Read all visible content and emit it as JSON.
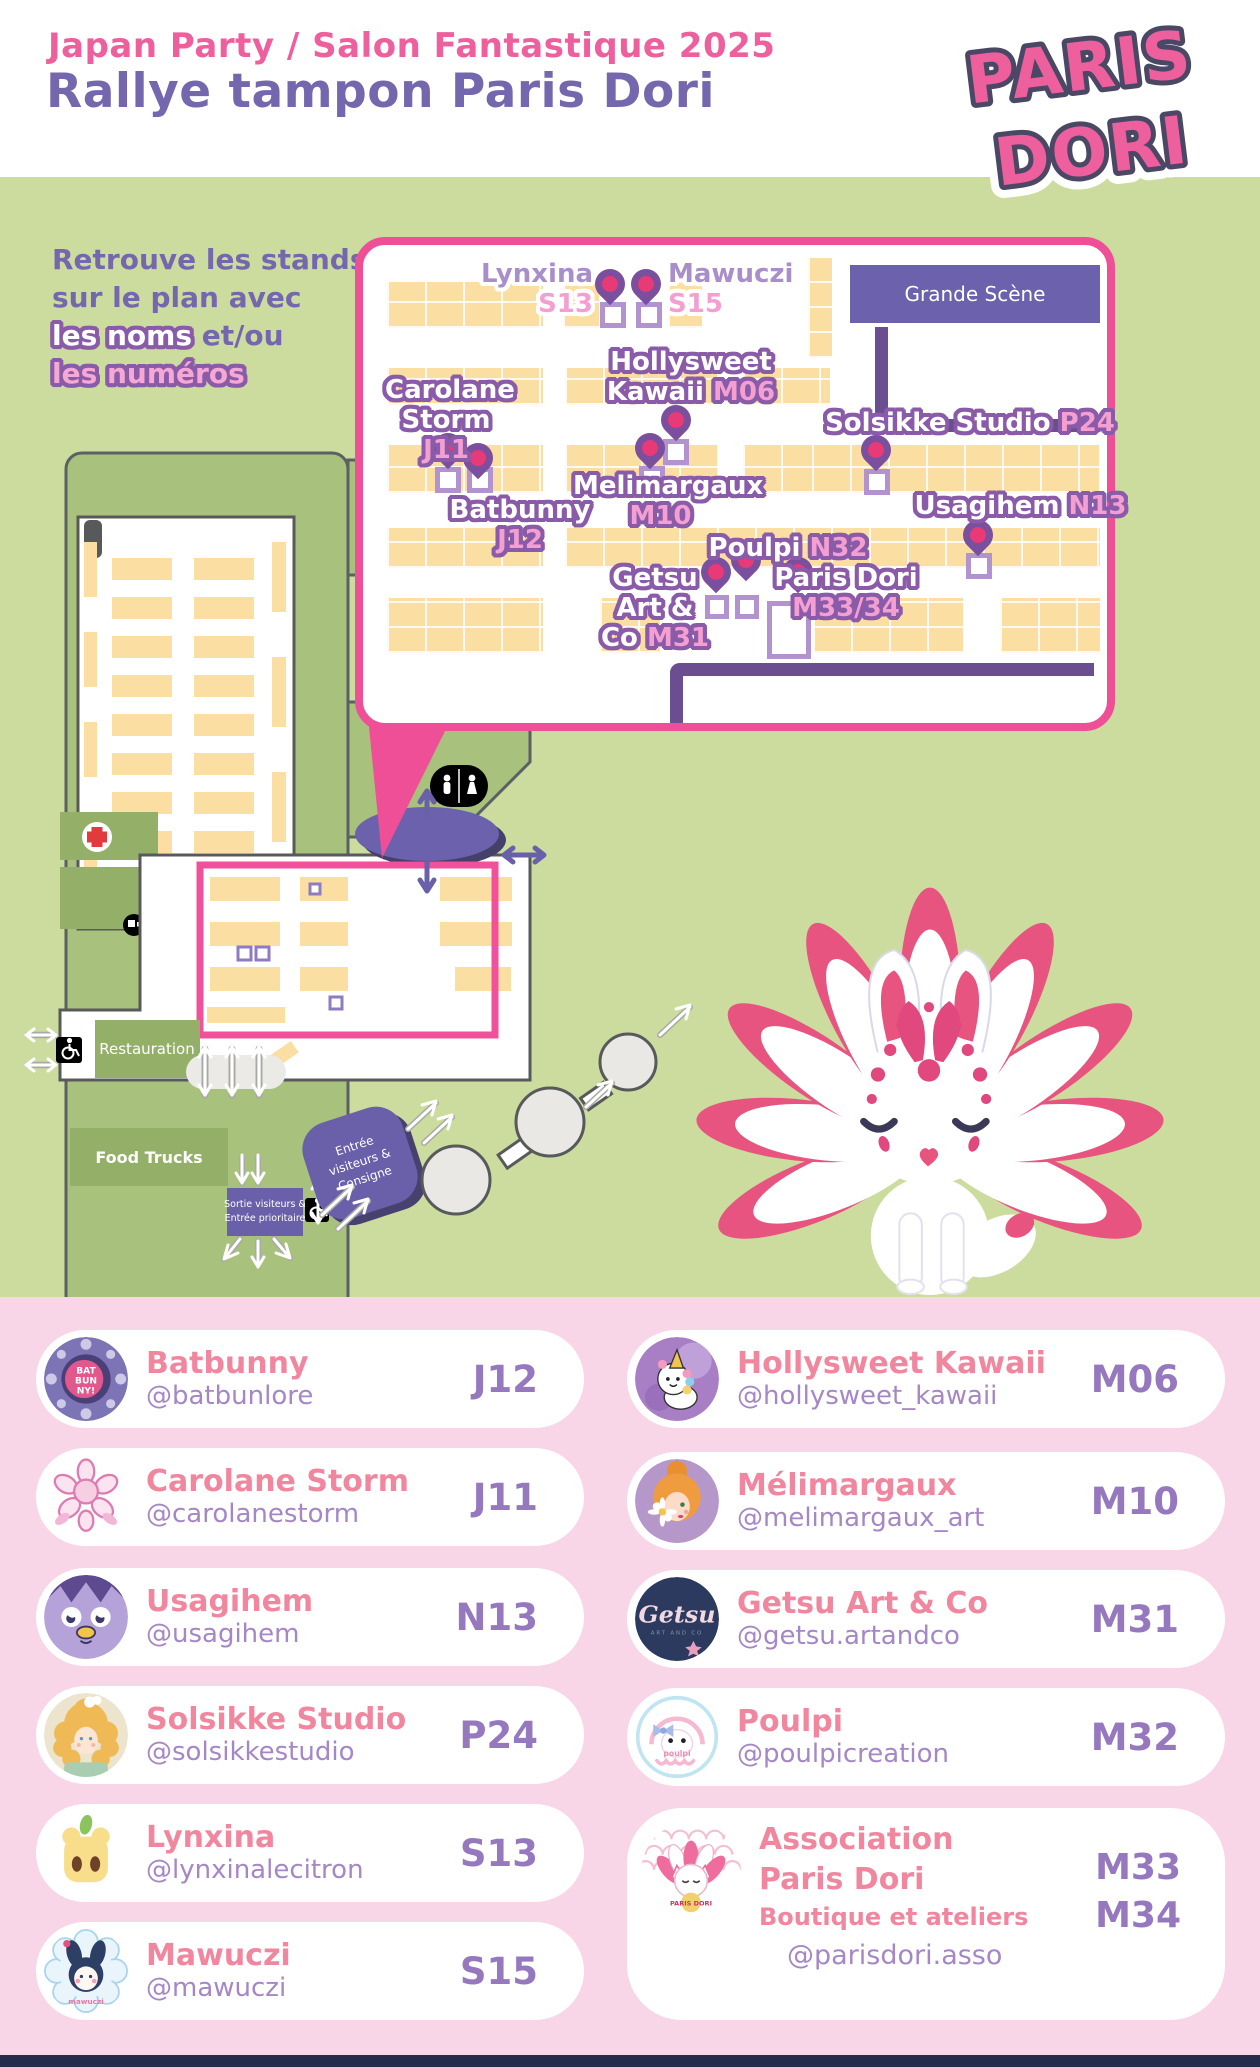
{
  "header": {
    "event_title": "Japan Party / Salon Fantastique 2025",
    "page_title": "Rallye tampon Paris Dori",
    "logo_line1": "PARIS",
    "logo_line2": "DORI"
  },
  "intro": {
    "line1": "Retrouve les stands",
    "line2": "sur le plan avec",
    "line3_highlight": "les noms",
    "line3_rest": " et/ou",
    "line4": "les numéros"
  },
  "callout": {
    "stage": "Grande Scène",
    "stands": {
      "lynxina": {
        "name": "Lynxina",
        "num": "S13"
      },
      "mawuczi": {
        "name": "Mawuczi",
        "num": "S15"
      },
      "carolane": {
        "name": "Carolane Storm",
        "num": "J11"
      },
      "batbunny": {
        "name": "Batbunny",
        "num": "J12"
      },
      "hollysweet": {
        "name": "Hollysweet Kawaii",
        "num": "M06"
      },
      "melimargaux": {
        "name": "Melimargaux",
        "num": "M10"
      },
      "solsikke": {
        "name": "Solsikke Studio",
        "num": "P24"
      },
      "usagihem": {
        "name": "Usagihem",
        "num": "N13"
      },
      "poulpi": {
        "name": "Poulpi",
        "num": "N32"
      },
      "getsu": {
        "name": "Getsu Art & Co",
        "num": "M31"
      },
      "parisdori": {
        "name": "Paris Dori",
        "num": "M33/34"
      }
    }
  },
  "map": {
    "restauration": "Restauration",
    "food_trucks": "Food Trucks",
    "entree_lines": [
      "Entrée",
      "visiteurs &",
      "Consigne"
    ],
    "sortie_lines": [
      "Sortie visiteurs &",
      "Entrée prioritaire"
    ],
    "icons": [
      "first-aid-cross-icon",
      "toilets-icon",
      "wheelchair-icon",
      "location-pin-icon"
    ]
  },
  "vendors": {
    "left": [
      {
        "name": "Batbunny",
        "handle": "@batbunlore",
        "num": "J12",
        "avatar": "batbunny-logo"
      },
      {
        "name": "Carolane Storm",
        "handle": "@carolanestorm",
        "num": "J11",
        "avatar": "carolane-rose-logo"
      },
      {
        "name": "Usagihem",
        "handle": "@usagihem",
        "num": "N13",
        "avatar": "usagihem-bird-logo"
      },
      {
        "name": "Solsikke Studio",
        "handle": "@solsikkestudio",
        "num": "P24",
        "avatar": "solsikke-girl-logo"
      },
      {
        "name": "Lynxina",
        "handle": "@lynxinalecitron",
        "num": "S13",
        "avatar": "lynxina-lemon-logo"
      },
      {
        "name": "Mawuczi",
        "handle": "@mawuczi",
        "num": "S15",
        "avatar": "mawuczi-bunny-logo"
      }
    ],
    "right": [
      {
        "name": "Hollysweet Kawaii",
        "handle": "@hollysweet_kawaii",
        "num": "M06",
        "avatar": "hollysweet-unicorn-logo"
      },
      {
        "name": "Mélimargaux",
        "handle": "@melimargaux_art",
        "num": "M10",
        "avatar": "melimargaux-portrait-logo"
      },
      {
        "name": "Getsu Art & Co",
        "handle": "@getsu.artandco",
        "num": "M31",
        "avatar": "getsu-logo"
      },
      {
        "name": "Poulpi",
        "handle": "@poulpicreation",
        "num": "M32",
        "avatar": "poulpi-octopus-logo"
      },
      {
        "name": "Association Paris Dori",
        "subtitle": "Boutique et ateliers",
        "handle": "@parisdori.asso",
        "num1": "M33",
        "num2": "M34",
        "avatar": "paris-dori-kitsune-logo"
      }
    ]
  },
  "colors": {
    "accent_pink": "#ef4f96",
    "title_pink": "#ee5f9e",
    "title_purple": "#7467ae",
    "map_green": "#cbdc9e",
    "stand_yellow": "#fbdfa2",
    "stage_purple": "#6c61ad",
    "cards_bg_pink": "#f8d6e7",
    "card_name_pink": "#f1879f",
    "card_number_purple": "#9678bf"
  }
}
